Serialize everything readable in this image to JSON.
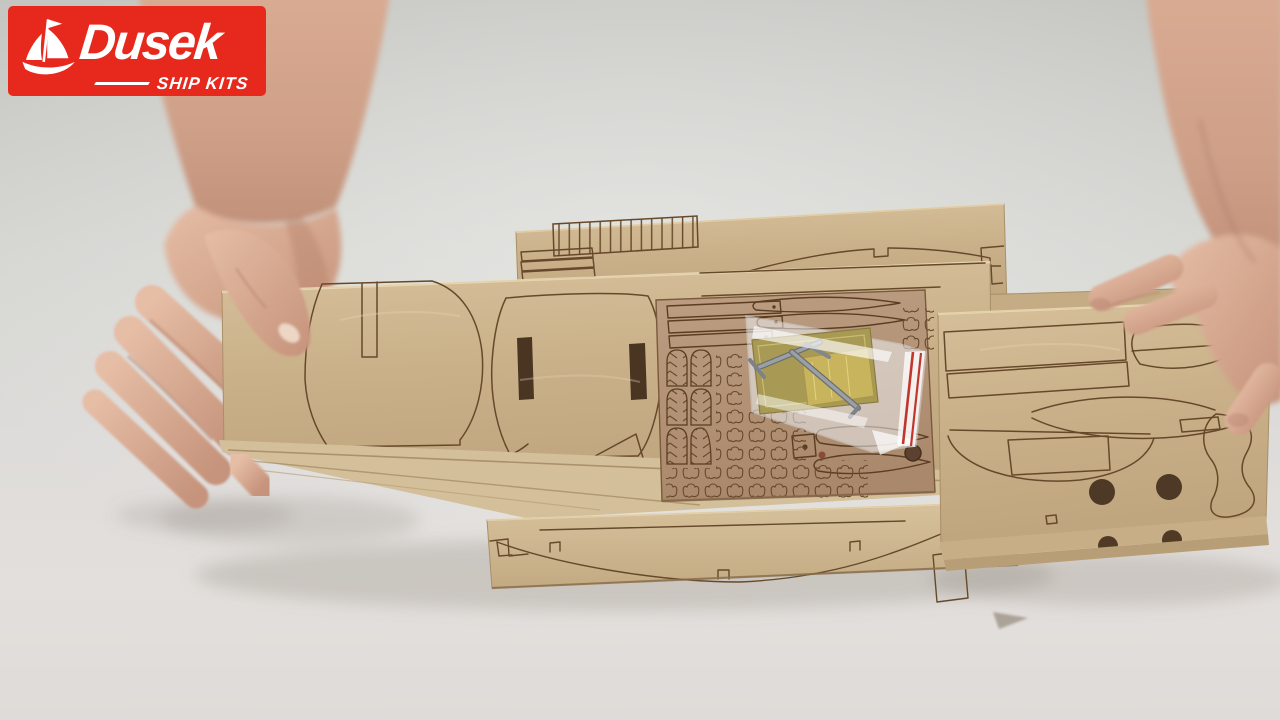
{
  "frame": {
    "kind": "video-still",
    "width": 1280,
    "height": 720
  },
  "logo": {
    "brand": "Dusek",
    "tagline": "SHIP KITS",
    "background_color": "#e7291d",
    "text_color": "#ffffff",
    "icon": "sailboat-icon"
  },
  "scene": {
    "objects": [
      "left-hand",
      "right-hand",
      "laser-cut-sheet-top",
      "laser-cut-sheet-main-bulkheads",
      "laser-cut-sheet-right",
      "laser-cut-sheet-bottom-keel",
      "fittings-sheet",
      "hardware-bag",
      "brass-etched-sheet",
      "metal-parts"
    ],
    "colors": {
      "wall": "#d2d3cf",
      "table": "#e2dedb",
      "plywood_light": "#ccb48d",
      "plywood_dark": "#b29275",
      "laser_cut_line": "#66492a",
      "bag_zip_red": "#c1352c",
      "brass": "#b3a355",
      "metal_grey": "#8b8f93",
      "skin": "#d6a88f"
    }
  }
}
